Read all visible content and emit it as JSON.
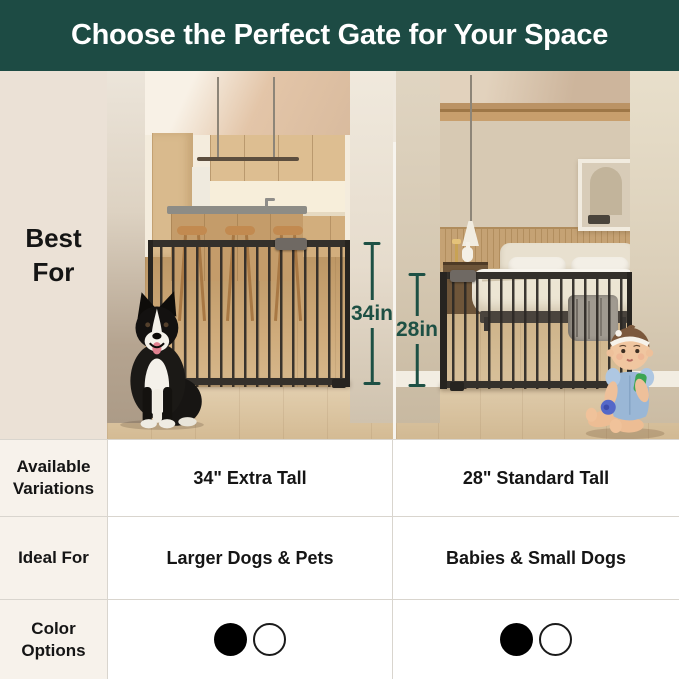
{
  "header": {
    "title": "Choose the Perfect Gate for Your Space",
    "bg_color": "#1D4B44",
    "text_color": "#FFFFFF"
  },
  "sidebar": {
    "label": "Best For",
    "bg_color": "#EBE1D6"
  },
  "panels": {
    "left": {
      "measurement_label": "34in"
    },
    "right": {
      "measurement_label": "28in"
    }
  },
  "measurement_color": "#1D5044",
  "table": {
    "rows": [
      {
        "label": "Available Variations",
        "left_value": "34\" Extra Tall",
        "right_value": "28\" Standard Tall"
      },
      {
        "label": "Ideal For",
        "left_value": "Larger Dogs & Pets",
        "right_value": "Babies & Small Dogs"
      },
      {
        "label": "Color Options"
      }
    ],
    "color_swatches": [
      "#000000",
      "#FFFFFF"
    ]
  }
}
